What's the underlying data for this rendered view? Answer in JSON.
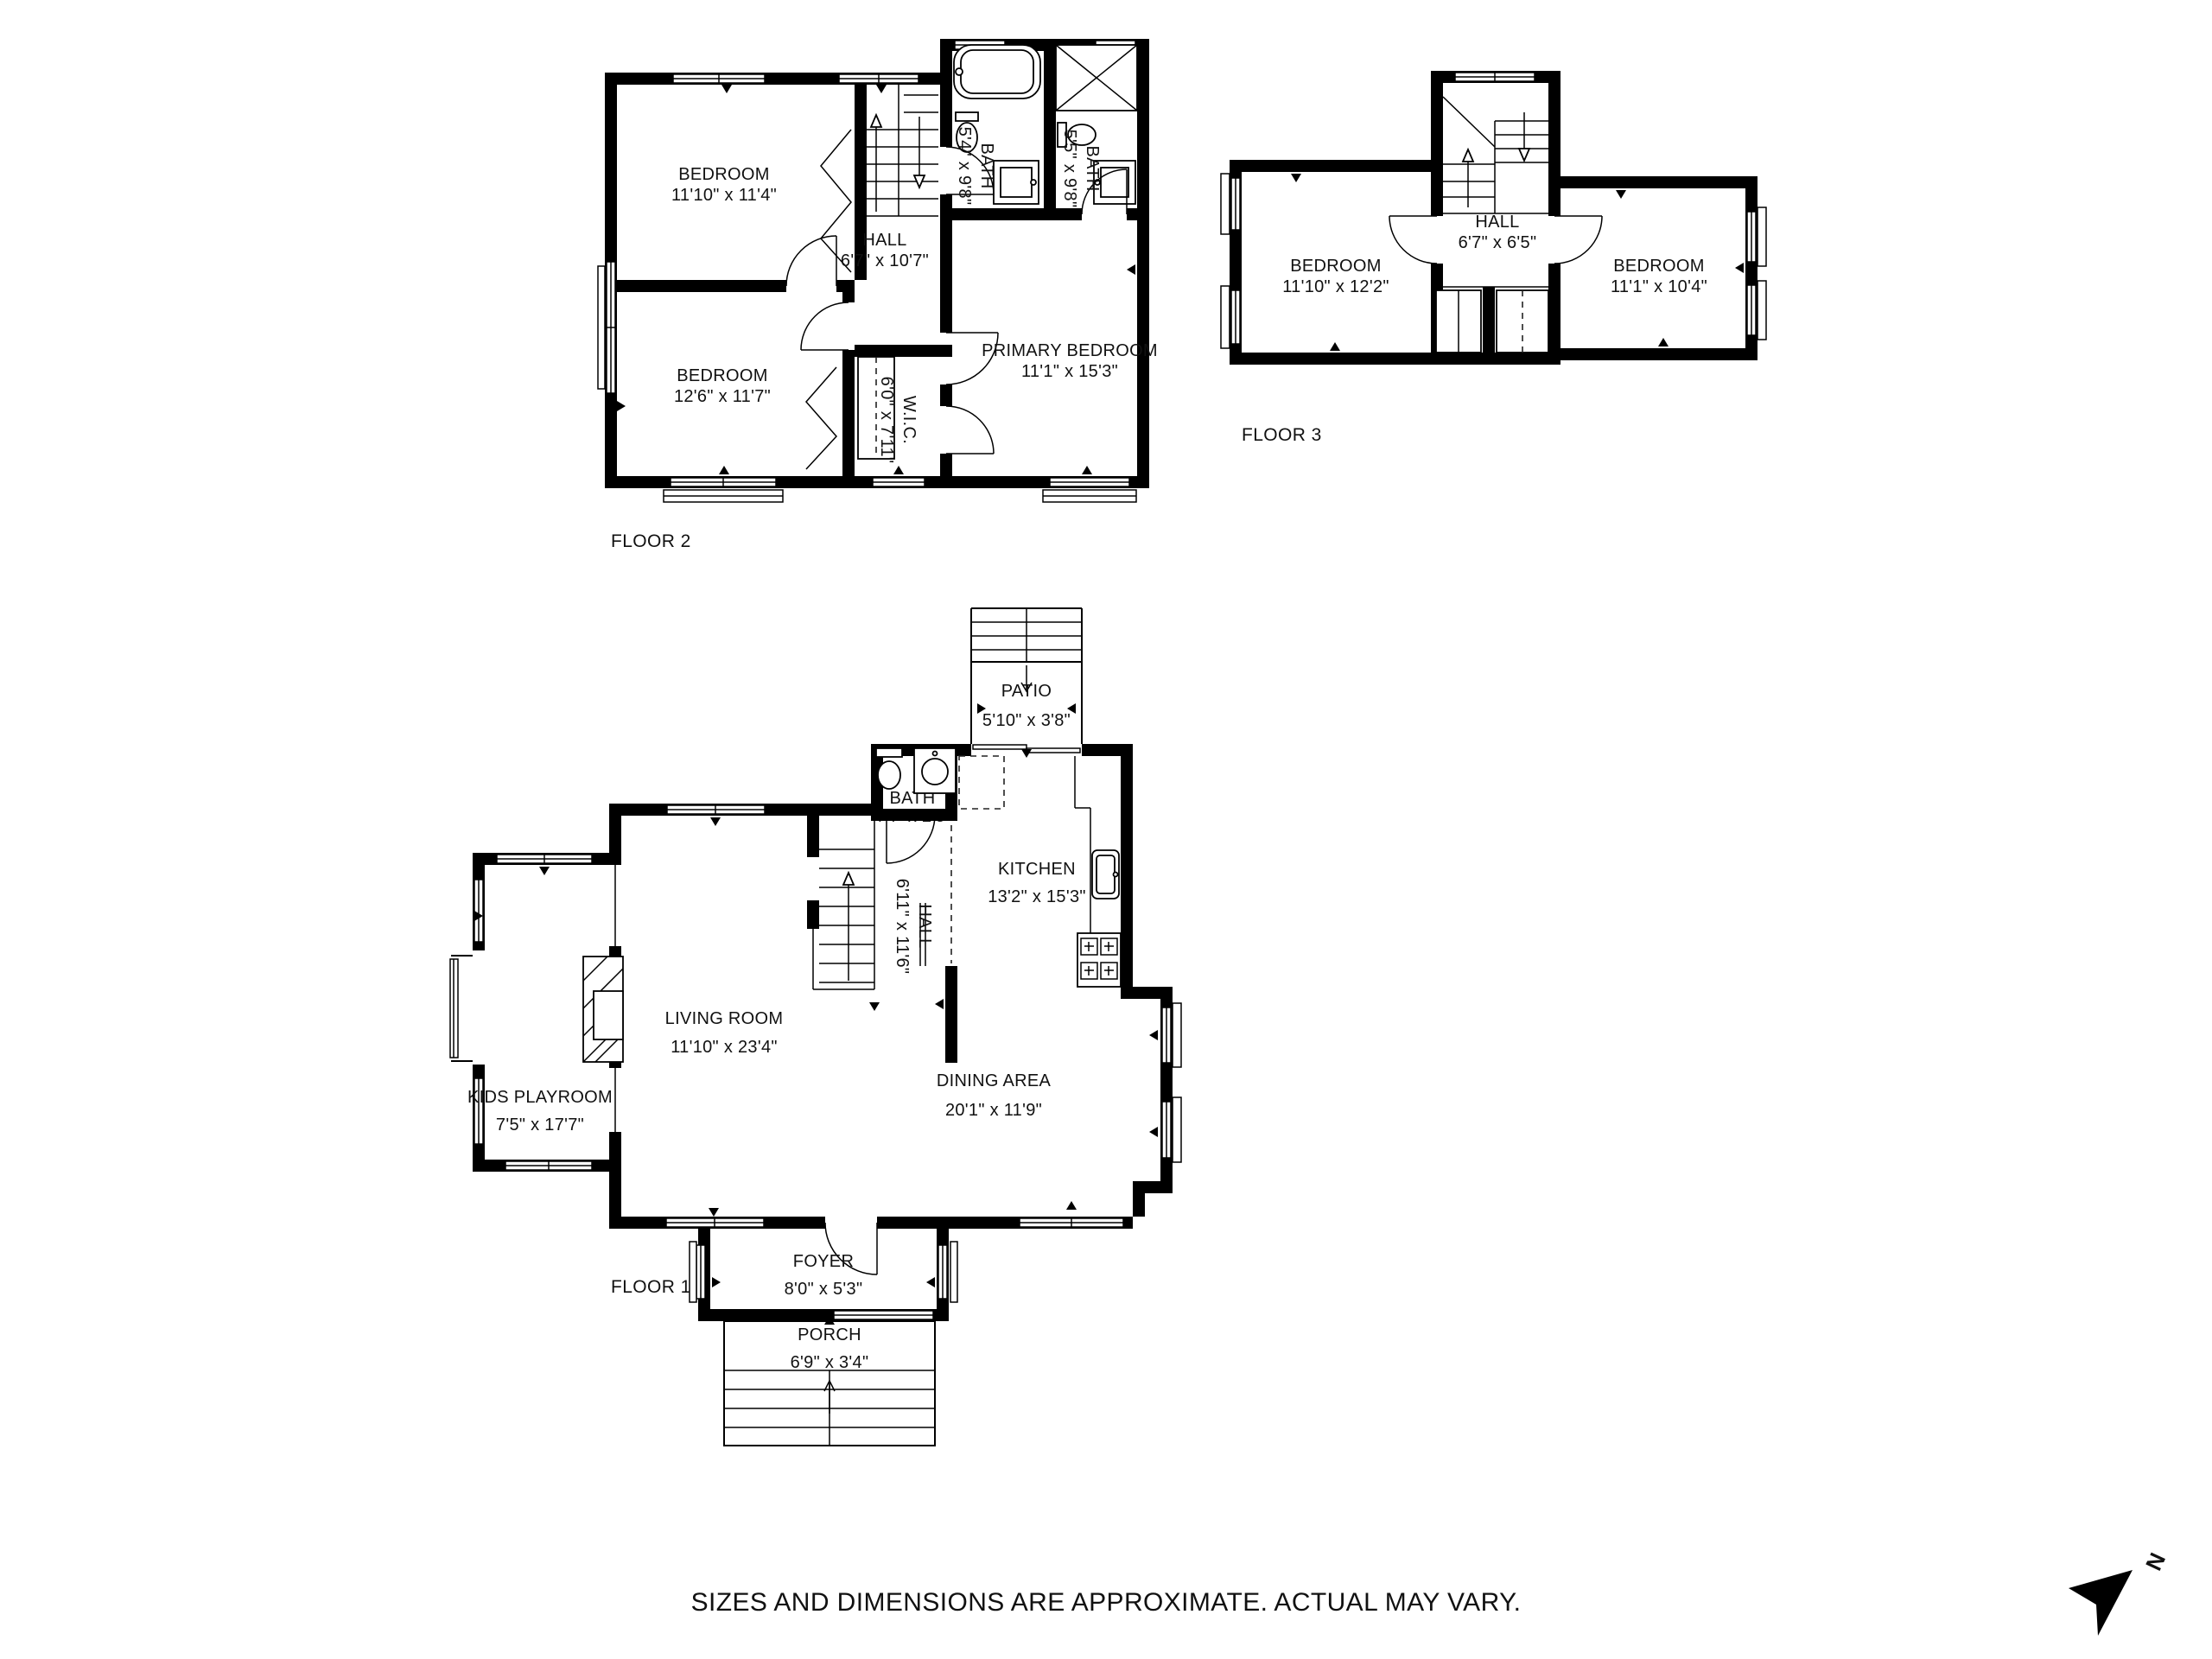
{
  "floors": {
    "f2": {
      "label": "FLOOR 2",
      "rooms": [
        {
          "name": "BEDROOM",
          "dims": "11'10\" x 11'4\""
        },
        {
          "name": "HALL",
          "dims": "6'7\" x 10'7\""
        },
        {
          "name": "BATH",
          "dims": "5'4\" x 9'8\""
        },
        {
          "name": "BATH",
          "dims": "5'5\" x 9'8\""
        },
        {
          "name": "BEDROOM",
          "dims": "12'6\" x 11'7\""
        },
        {
          "name": "W.I.C.",
          "dims": "6'0\" x 7'11\""
        },
        {
          "name": "PRIMARY BEDROOM",
          "dims": "11'1\" x 15'3\""
        }
      ]
    },
    "f3": {
      "label": "FLOOR 3",
      "rooms": [
        {
          "name": "HALL",
          "dims": "6'7\" x 6'5\""
        },
        {
          "name": "BEDROOM",
          "dims": "11'10\" x 12'2\""
        },
        {
          "name": "BEDROOM",
          "dims": "11'1\" x 10'4\""
        }
      ]
    },
    "f1": {
      "label": "FLOOR 1",
      "rooms": [
        {
          "name": "PATIO",
          "dims": "5'10\" x 3'8\""
        },
        {
          "name": "BATH",
          "dims": "4'4\" x 2'5\""
        },
        {
          "name": "KITCHEN",
          "dims": "13'2\" x 15'3\""
        },
        {
          "name": "HALL",
          "dims": "6'11\" x 11'6\""
        },
        {
          "name": "LIVING ROOM",
          "dims": "11'10\" x 23'4\""
        },
        {
          "name": "KIDS PLAYROOM",
          "dims": "7'5\" x 17'7\""
        },
        {
          "name": "DINING AREA",
          "dims": "20'1\" x 11'9\""
        },
        {
          "name": "FOYER",
          "dims": "8'0\" x 5'3\""
        },
        {
          "name": "PORCH",
          "dims": "6'9\" x 3'4\""
        }
      ]
    }
  },
  "disclaimer": "SIZES AND DIMENSIONS ARE APPROXIMATE. ACTUAL MAY VARY.",
  "compass": {
    "north_label": "N"
  },
  "colors": {
    "walls": "#000000",
    "background": "#ffffff",
    "text": "#111111"
  }
}
